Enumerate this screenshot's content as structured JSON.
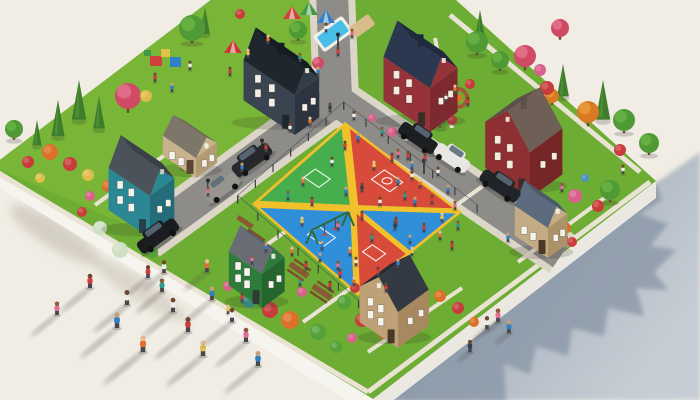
{
  "scene": {
    "palette": {
      "bg": "#f1ede4",
      "grass": "#6dad33",
      "park_grass": "#79b637",
      "road": "#8d8c89",
      "sidewalk": "#dcd6c8",
      "path": "#e9e3d4",
      "slab_front": "#f6f4ee",
      "slab_side": "#ebe8e1",
      "shadow_main": "#8d9aab",
      "shadow_far": "#c6cdd4",
      "shadow_soft": "#b3ab9d",
      "fence": "#3b4046",
      "lamp": "#2a2d31",
      "wood": "#8a5a34"
    },
    "court": {
      "yellow": "#f1c12c",
      "green": "#46ae4c",
      "red": "#d84b3a",
      "blue": "#2f8fd8",
      "line": "#ffffff",
      "corners": {
        "n": [
          345,
          122
        ],
        "e": [
          462,
          212
        ],
        "s": [
          358,
          296
        ],
        "w": [
          252,
          204
        ]
      }
    },
    "houses": [
      {
        "name": "dark-slate-house",
        "s": [
          295,
          135
        ],
        "wA": 62,
        "wB": 30,
        "h": 40,
        "roofH": 24,
        "ridge": "u",
        "wallA": "#3a4450",
        "wallB": "#2c343f",
        "roof": "#1f262e",
        "roof2": "#161c22",
        "gable": "#333d49",
        "trim": "#f3efe6",
        "door": "#20262d",
        "chimney": true
      },
      {
        "name": "red-house-north",
        "s": [
          430,
          132
        ],
        "wA": 56,
        "wB": 34,
        "h": 44,
        "roofH": 26,
        "ridge": "u",
        "wallA": "#96323a",
        "wallB": "#7c2930",
        "roof": "#2b3850",
        "roof2": "#202a3d",
        "gable": "#96323a",
        "trim": "#f3ecdc",
        "door": "#3a2e24",
        "chimney": true
      },
      {
        "name": "teal-house",
        "s": [
          150,
          238
        ],
        "wA": 50,
        "wB": 30,
        "h": 42,
        "roofH": 24,
        "ridge": "u",
        "wallA": "#2c8794",
        "wallB": "#226d79",
        "roof": "#4c525a",
        "roof2": "#3c4149",
        "gable": "#2c8794",
        "trim": "#f6f3ea",
        "door": "#274049",
        "chimney": false
      },
      {
        "name": "tan-bungalow",
        "s": [
          196,
          178
        ],
        "wA": 40,
        "wB": 26,
        "h": 20,
        "roofH": 13,
        "ridge": "u",
        "wallA": "#c8b28c",
        "wallB": "#b29a74",
        "roof": "#7d766a",
        "roof2": "#6b655a",
        "gable": "#c8b28c",
        "trim": "#f6f3ea",
        "door": "#5a4634",
        "chimney": false
      },
      {
        "name": "red-house-east",
        "s": [
          530,
          198
        ],
        "wA": 54,
        "wB": 40,
        "h": 46,
        "roofH": 26,
        "ridge": "w",
        "wallA": "#8e2f33",
        "wallB": "#772628",
        "roof": "#6e6057",
        "roof2": "#5c5048",
        "gable": "#8e2f33",
        "trim": "#f3ecdc",
        "door": "#3a2e24",
        "chimney": true
      },
      {
        "name": "green-house",
        "s": [
          262,
          308
        ],
        "wA": 40,
        "wB": 28,
        "h": 34,
        "roofH": 18,
        "ridge": "u",
        "wallA": "#2e7c3c",
        "wallB": "#256630",
        "roof": "#686d74",
        "roof2": "#565b62",
        "gable": "#2e7c3c",
        "trim": "#f6f3ea",
        "door": "#2e3b30",
        "chimney": false
      },
      {
        "name": "tan-house-south",
        "s": [
          398,
          348
        ],
        "wA": 46,
        "wB": 38,
        "h": 36,
        "roofH": 22,
        "ridge": "w",
        "wallA": "#bfa178",
        "wallB": "#a8895f",
        "roof": "#333a43",
        "roof2": "#272d35",
        "gable": "#bfa178",
        "trim": "#f6f3ea",
        "door": "#4a3826",
        "chimney": false
      },
      {
        "name": "khaki-house-se",
        "s": [
          548,
          258
        ],
        "wA": 40,
        "wB": 24,
        "h": 30,
        "roofH": 18,
        "ridge": "u",
        "wallA": "#c3ab84",
        "wallB": "#ac9268",
        "roof": "#5d6b7e",
        "roof2": "#4c5969",
        "gable": "#c3ab84",
        "trim": "#f6f3ea",
        "door": "#4a3826",
        "chimney": false
      }
    ],
    "trees": {
      "cypress": [
        [
          58,
          120,
          20
        ],
        [
          79,
          102,
          22
        ],
        [
          99,
          114,
          18
        ],
        [
          37,
          134,
          14
        ],
        [
          480,
          26,
          16
        ],
        [
          563,
          82,
          18
        ],
        [
          603,
          102,
          22
        ],
        [
          205,
          22,
          15
        ]
      ],
      "round": [
        [
          192,
          28,
          13
        ],
        [
          14,
          129,
          9
        ],
        [
          477,
          42,
          11
        ],
        [
          500,
          60,
          9
        ],
        [
          624,
          120,
          11
        ],
        [
          649,
          143,
          10
        ],
        [
          610,
          190,
          10
        ],
        [
          440,
          118,
          8
        ],
        [
          186,
          158,
          8
        ],
        [
          298,
          30,
          9
        ]
      ],
      "blossom": [
        [
          128,
          96,
          13
        ],
        [
          417,
          73,
          10
        ],
        [
          525,
          56,
          11
        ],
        [
          318,
          63,
          6
        ],
        [
          560,
          28,
          9
        ]
      ],
      "autumn": [
        [
          588,
          112,
          11
        ],
        [
          552,
          96,
          7
        ]
      ]
    },
    "bush_colors": {
      "red": "#c93c3c",
      "orange": "#dd7028",
      "yellow": "#dfbd4a",
      "pink": "#d9608c",
      "pale": "#cfe0c2",
      "green": "#55a23a",
      "teal": "#3e9a8e",
      "blue": "#4a90c8"
    },
    "bushes": [
      [
        50,
        152,
        8,
        "orange"
      ],
      [
        70,
        164,
        7,
        "red"
      ],
      [
        88,
        175,
        6,
        "yellow"
      ],
      [
        28,
        162,
        6,
        "red"
      ],
      [
        108,
        186,
        6,
        "orange"
      ],
      [
        40,
        178,
        5,
        "yellow"
      ],
      [
        100,
        228,
        7,
        "pale"
      ],
      [
        120,
        250,
        8,
        "pale"
      ],
      [
        82,
        212,
        5,
        "red"
      ],
      [
        152,
        252,
        6,
        "green"
      ],
      [
        90,
        196,
        5,
        "pink"
      ],
      [
        146,
        96,
        6,
        "yellow"
      ],
      [
        240,
        14,
        5,
        "red"
      ],
      [
        392,
        132,
        5,
        "pink"
      ],
      [
        406,
        137,
        4,
        "pale"
      ],
      [
        452,
        120,
        5,
        "red"
      ],
      [
        372,
        118,
        4,
        "pink"
      ],
      [
        448,
        80,
        6,
        "pink"
      ],
      [
        470,
        84,
        5,
        "red"
      ],
      [
        547,
        88,
        7,
        "red"
      ],
      [
        540,
        70,
        6,
        "pink"
      ],
      [
        620,
        150,
        6,
        "red"
      ],
      [
        548,
        222,
        7,
        "pink"
      ],
      [
        575,
        196,
        7,
        "pink"
      ],
      [
        598,
        206,
        6,
        "red"
      ],
      [
        562,
        238,
        6,
        "red"
      ],
      [
        585,
        178,
        4,
        "blue"
      ],
      [
        532,
        208,
        5,
        "green"
      ],
      [
        565,
        228,
        6,
        "orange"
      ],
      [
        572,
        242,
        5,
        "red"
      ],
      [
        249,
        300,
        8,
        "teal"
      ],
      [
        270,
        310,
        8,
        "red"
      ],
      [
        290,
        320,
        9,
        "orange"
      ],
      [
        318,
        332,
        8,
        "green"
      ],
      [
        344,
        302,
        7,
        "green"
      ],
      [
        362,
        320,
        7,
        "red"
      ],
      [
        384,
        332,
        7,
        "orange"
      ],
      [
        336,
        347,
        6,
        "green"
      ],
      [
        228,
        286,
        5,
        "pink"
      ],
      [
        302,
        292,
        5,
        "pink"
      ],
      [
        355,
        288,
        5,
        "red"
      ],
      [
        440,
        296,
        6,
        "orange"
      ],
      [
        458,
        308,
        6,
        "red"
      ],
      [
        474,
        322,
        5,
        "orange"
      ],
      [
        352,
        338,
        5,
        "pink"
      ],
      [
        430,
        148,
        5,
        "green"
      ]
    ],
    "shirts": [
      "#cf3d3d",
      "#e07030",
      "#2f7fc1",
      "#2e9d8a",
      "#f0ede6",
      "#e4c14a",
      "#8a4ea8",
      "#df6f97",
      "#32404e",
      "#f2f2ef"
    ],
    "skins": [
      "#8a5a3c",
      "#caa07a",
      "#e8c09a",
      "#6e4730"
    ],
    "people": {
      "court": [
        [
          345,
          150,
          0
        ],
        [
          358,
          142,
          2
        ],
        [
          332,
          166,
          4
        ],
        [
          303,
          186,
          1
        ],
        [
          288,
          200,
          3
        ],
        [
          312,
          206,
          0
        ],
        [
          346,
          196,
          2
        ],
        [
          374,
          170,
          5
        ],
        [
          392,
          162,
          0
        ],
        [
          398,
          186,
          2
        ],
        [
          380,
          206,
          4
        ],
        [
          362,
          220,
          0
        ],
        [
          338,
          230,
          7
        ],
        [
          322,
          250,
          2
        ],
        [
          350,
          256,
          1
        ],
        [
          372,
          242,
          3
        ],
        [
          396,
          226,
          0
        ],
        [
          415,
          206,
          2
        ],
        [
          302,
          226,
          5
        ],
        [
          362,
          192,
          8
        ],
        [
          340,
          278,
          0
        ],
        [
          412,
          180,
          4
        ]
      ],
      "lawn_ne": [
        [
          398,
          158,
          7
        ],
        [
          412,
          170,
          2
        ],
        [
          425,
          162,
          0
        ],
        [
          438,
          176,
          4
        ],
        [
          420,
          188,
          1
        ],
        [
          405,
          200,
          3
        ],
        [
          432,
          204,
          0
        ],
        [
          448,
          194,
          2
        ],
        [
          455,
          210,
          7
        ],
        [
          442,
          222,
          5
        ],
        [
          424,
          232,
          0
        ],
        [
          410,
          244,
          2
        ],
        [
          440,
          240,
          1
        ],
        [
          458,
          230,
          3
        ],
        [
          395,
          230,
          8
        ],
        [
          452,
          250,
          0
        ]
      ],
      "lawn_s": [
        [
          292,
          256,
          1
        ],
        [
          306,
          270,
          0
        ],
        [
          320,
          262,
          2
        ],
        [
          338,
          270,
          7
        ],
        [
          356,
          266,
          4
        ],
        [
          378,
          276,
          0
        ],
        [
          398,
          268,
          2
        ],
        [
          412,
          256,
          5
        ],
        [
          300,
          286,
          3
        ],
        [
          330,
          290,
          0
        ],
        [
          354,
          286,
          1
        ],
        [
          266,
          252,
          2
        ],
        [
          252,
          264,
          7
        ],
        [
          386,
          292,
          0
        ]
      ],
      "park": [
        [
          155,
          82,
          0
        ],
        [
          172,
          92,
          2
        ],
        [
          248,
          58,
          5
        ],
        [
          268,
          44,
          1
        ],
        [
          352,
          38,
          7
        ],
        [
          300,
          62,
          3
        ],
        [
          230,
          76,
          0
        ],
        [
          190,
          70,
          4
        ]
      ],
      "street": [
        [
          326,
          32,
          4
        ],
        [
          338,
          56,
          0
        ],
        [
          318,
          76,
          2
        ],
        [
          330,
          112,
          8
        ],
        [
          310,
          126,
          1
        ],
        [
          290,
          132,
          4
        ],
        [
          266,
          152,
          0
        ],
        [
          242,
          172,
          2
        ],
        [
          208,
          196,
          7
        ],
        [
          382,
          136,
          3
        ],
        [
          408,
          160,
          0
        ],
        [
          354,
          120,
          4
        ]
      ],
      "misc": [
        [
          455,
          94,
          1
        ],
        [
          468,
          106,
          0
        ],
        [
          446,
          102,
          4
        ],
        [
          562,
          192,
          7
        ],
        [
          623,
          174,
          4
        ],
        [
          508,
          242,
          2
        ],
        [
          242,
          302,
          0
        ],
        [
          228,
          314,
          5
        ]
      ]
    },
    "walkers": {
      "bottom_left": [
        [
          90,
          288,
          1.0,
          0,
          34
        ],
        [
          127,
          305,
          1.05,
          4,
          40
        ],
        [
          117,
          328,
          1.1,
          2,
          44
        ],
        [
          143,
          352,
          1.15,
          1,
          48
        ],
        [
          57,
          315,
          0.95,
          7,
          30
        ],
        [
          162,
          292,
          0.95,
          3,
          30
        ],
        [
          173,
          312,
          1.0,
          4,
          36
        ],
        [
          188,
          332,
          1.05,
          0,
          40
        ],
        [
          203,
          356,
          1.1,
          5,
          44
        ],
        [
          212,
          300,
          0.95,
          2,
          32
        ],
        [
          232,
          322,
          1.0,
          4,
          36
        ],
        [
          207,
          272,
          0.9,
          1,
          26
        ],
        [
          164,
          273,
          0.9,
          4,
          24
        ],
        [
          148,
          278,
          0.9,
          0,
          24
        ],
        [
          246,
          342,
          1.0,
          7,
          36
        ],
        [
          258,
          366,
          1.05,
          2,
          40
        ]
      ],
      "on_shadow": [
        [
          487,
          329,
          0.9,
          4,
          14
        ],
        [
          498,
          322,
          0.95,
          7,
          14
        ],
        [
          509,
          333,
          0.9,
          2,
          14
        ],
        [
          470,
          352,
          0.85,
          8,
          12
        ]
      ]
    },
    "cars": [
      {
        "name": "black-car-driveway",
        "x": 418,
        "y": 138,
        "a": 34,
        "c": "#1c1e21",
        "l": 42
      },
      {
        "name": "white-car",
        "x": 452,
        "y": 158,
        "a": 34,
        "c": "#e9e7e3",
        "l": 38
      },
      {
        "name": "black-car-east",
        "x": 500,
        "y": 186,
        "a": 34,
        "c": "#202327",
        "l": 44
      },
      {
        "name": "black-suv-mid",
        "x": 252,
        "y": 160,
        "a": -36,
        "c": "#26282c",
        "l": 44
      },
      {
        "name": "black-suv-west",
        "x": 158,
        "y": 236,
        "a": -36,
        "c": "#1a1c1f",
        "l": 46
      },
      {
        "name": "gray-car",
        "x": 222,
        "y": 188,
        "a": -36,
        "c": "#96968f",
        "l": 38
      }
    ],
    "props": {
      "pool": {
        "x": 333,
        "y": 34,
        "deck": "#f2efe8",
        "water": "#49bfe8"
      },
      "sandbox": {
        "x": 362,
        "y": 26,
        "sand": "#d9bc8c"
      },
      "tents": [
        [
          292,
          6,
          "#d23f3f"
        ],
        [
          309,
          2,
          "#3f9a43"
        ],
        [
          326,
          10,
          "#2f82c8"
        ],
        [
          233,
          40,
          "#cc3434"
        ]
      ],
      "blocks": {
        "x": 158,
        "y": 56,
        "colors": [
          "#d23f3f",
          "#e4c14a",
          "#2f82c8",
          "#3f9a43"
        ]
      },
      "slide": {
        "x": 254,
        "y": 44,
        "red": "#d23f3f",
        "yellow": "#e4c14a"
      },
      "firepit": {
        "x": 458,
        "y": 98,
        "brick": "#a05a3a",
        "fire": "#e07428"
      },
      "tables": [
        [
          253,
          240
        ],
        [
          299,
          270
        ],
        [
          322,
          292
        ]
      ],
      "bench": [
        245,
        222
      ],
      "swing": {
        "x1": 312,
        "y1": 230,
        "x2": 348,
        "y2": 212,
        "color": "#2f6b3a"
      },
      "lamps": [
        [
          303,
          74
        ],
        [
          262,
          142
        ],
        [
          208,
          182
        ],
        [
          424,
          162
        ],
        [
          338,
          36
        ]
      ]
    }
  }
}
